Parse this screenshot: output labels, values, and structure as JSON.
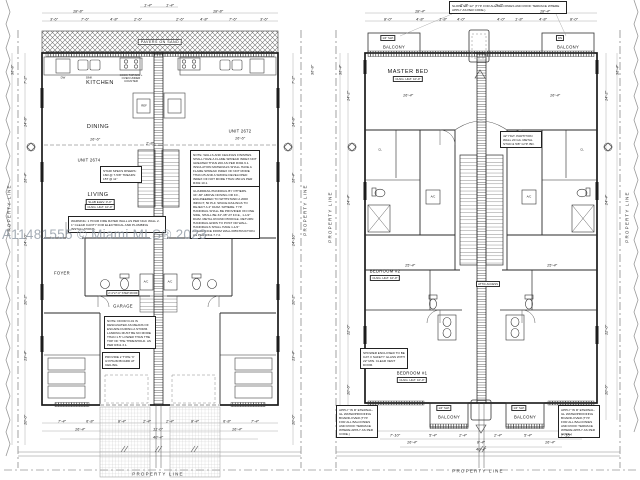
{
  "sheet": {
    "watermark": "A11481555 © Miami MLS® 2023",
    "property_line": "PROPERTY LINE"
  },
  "left_plan": {
    "pavers": "PAVERS ON SAND",
    "kitchen": "KITCHEN",
    "dining": "DINING",
    "unit_left": "UNIT 2674",
    "unit_right": "UNIT 2672",
    "living": "LIVING",
    "foyer": "FOYER",
    "garage": "GARAGE",
    "ac": "A/C",
    "dw": "DW",
    "sink": "SINK",
    "ref": "REF",
    "cook": "COOK TOP/MW + OVEN UNDER COUNTER",
    "slab_tag": "SLAB ELEV. 0'-0\"",
    "clng_tag": "CLNG. HGT. 10'-0\"",
    "step_roof": "2'-4\"x7'-0\" STEP ROOF",
    "stair_specs": "STAIR SPECS RISERS: 16R @ 7-5/8\" TREADS: 15T @ 11\"",
    "warning": "WARNING: 1 HOUR FIRE RATED WALL AS PER NGC WALL 2. 1\" CLEAR CAVITY FOR ELECTRICAL AND PLUMBING INSTALLATIONS.",
    "note_flame": "NOTE: WALLS AND CEILINGS FINISHES SHALL HAVE A FLAME SPREAD INDEX NOT GREATER THAN 200 AS PER R302.9.1. INSULATION MATERIALS SHALL HAVE A FLAME SPREAD INDEX OF NOT MORE THAN 25 AND A SMOKE DEVELOPED INDEX OF NOT MORE THAN 450 AS PER R302.10.1.",
    "note_guardrail": "GUARDRAIL/HANDRAIL BY OTHERS. 34\"-38\" ABOVE NOSING OR F.F., ENGINEERED TO WITHSTAND A 200# IMPACT, 50 PLF. SPACE RAILINGS TO REJECT A 4\" DIAM. SPHERE. TYP. HANDRAIL SHALL BE PROVIDED ON ONE SIDE, SHALL BE 34\"-38\" AT F.F.E., 1-1/2\" DIAM. METAL ROUND PROFILE. RETURN HANDRAIL ENDS TO POST OR WALL. HANDRAILS SHALL HAVE 1-1/2\" CLEARANCE FROM WALL/OBSTRUCTION. AS PER R311.7.7.2.",
    "note_door": "NOTE: DOOR D-01 IS DESIGNATED AS MEANS OF ESCAPE DURING A STORM. LANDING MUST BE NO MORE THAN 1.5\" LOWER THAN THE TOP OF THE THRESHOLD. AS PER R311.3.1.",
    "note_gypsum": "PROVIDE 2 TYPE 'X' GYPSUM BOARD AT CEILING."
  },
  "right_plan": {
    "master": "MASTER BED",
    "clng_tag": "CLNG. HGT. 10'-0\"",
    "bedroom2": "BEDROOM #2",
    "bedroom1": "BEDROOM #1",
    "balcony": "BALCONY",
    "slp": "1/4\" SLP.",
    "dn": "DN",
    "cl": "CL",
    "ac": "A/C",
    "attic": "ATTIC ACCESS",
    "note_roof": "SLOPE 1/4\":12\" (TYP. FOR ALL BALCONIES AND ROOF TERRACE WHERE APPLY AS PER CODE.)",
    "note_partition": "42\" HGT. PARTITION WALL 20 GA. METAL STUD & 5/8\" GYP. BD.",
    "note_shower": "SHOWER ENCLOSED TO BE CAT. II SAFETY GLASS WITH 22\" MIN. CLEAR VENT DOOR.",
    "note_wp": "APPLY 'W R' ETERNAL-GL WATERPROOFING BOARD-OVER (TYP. FOR ALL BALCONIES AND ROOF TERRACE WHERE APPLY AS PER CODE.)"
  },
  "d": [
    "18'-8\"",
    "18'-8\"",
    "3'-6\"",
    "7'-6\"",
    "4'-8\"",
    "2'-6\"",
    "2'-6\"",
    "4'-8\"",
    "7'-6\"",
    "3'-6\"",
    "1'-4\"",
    "1'-4\"",
    "36'-8\"",
    "7'-2\"",
    "14'-8\"",
    "16'-4\"",
    "14'-10\"",
    "10'-2\"",
    "13'-4\"",
    "10'-0\"",
    "7'-2\"",
    "14'-8\"",
    "16'-4\"",
    "14'-10\"",
    "10'-2\"",
    "13'-4\"",
    "10'-0\"",
    "36'-8\"",
    "16'-6\"",
    "16'-6\"",
    "2'-8\"",
    "7'-4\"",
    "6'-8\"",
    "8'-4\"",
    "2'-4\"",
    "2'-4\"",
    "8'-4\"",
    "6'-8\"",
    "7'-4\"",
    "16'-4\"",
    "11'-0\"",
    "16'-4\"",
    "40'-4\"",
    "18'-4\"",
    "18'-4\"",
    "8'-0\"",
    "4'-8\"",
    "1'-8\"",
    "4'-0\"",
    "4'-0\"",
    "1'-8\"",
    "4'-8\"",
    "8'-0\"",
    "2'-2\"",
    "2'-2\"",
    "36'-4\"",
    "14'-2\"",
    "24'-4\"",
    "12'-0\"",
    "10'-6\"",
    "14'-2\"",
    "24'-4\"",
    "12'-0\"",
    "10'-6\"",
    "36'-4\"",
    "16'-4\"",
    "16'-4\"",
    "15'-4\"",
    "15'-4\"",
    "7'-10\"",
    "5'-4\"",
    "2'-4\"",
    "2'-4\"",
    "5'-4\"",
    "7'-10\"",
    "16'-4\"",
    "8'-4\"",
    "16'-4\"",
    "40'-4\""
  ]
}
